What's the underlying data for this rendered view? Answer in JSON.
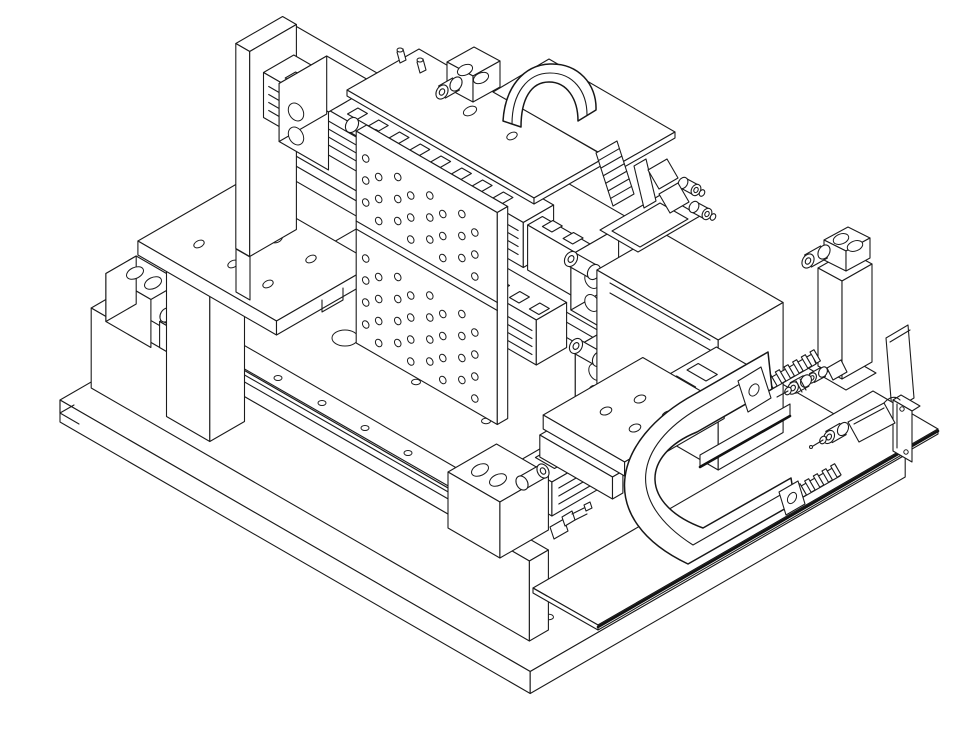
{
  "drawing": {
    "type": "isometric-cad-line-drawing",
    "subject": "Two-axis linear stage positioning assembly, isometric CAD view",
    "background_color": "#ffffff",
    "line_color": "#1b1b1b",
    "heavy_line_color": "#121212",
    "projection": "isometric",
    "has_text": false
  },
  "components": {
    "base_plate": {
      "label": "Machine base plate with mounting holes"
    },
    "left_riser_wall": {
      "label": "Left riser support wall"
    },
    "left_linear_rail": {
      "label": "Left linear guide rail"
    },
    "left_motor_block": {
      "label": "Left rail end motor block"
    },
    "left_support_column": {
      "label": "Left support column"
    },
    "left_tooling_plate": {
      "label": "Left tooling plate with holes"
    },
    "gantry_beam": {
      "label": "Gantry beam body"
    },
    "upper_linear_stage": {
      "label": "Upper linear stage rail"
    },
    "upper_stage_motor_left": {
      "label": "Upper stage motor block, left end"
    },
    "upper_stage_motor_right": {
      "label": "Upper stage motor block, right end"
    },
    "lower_linear_stage": {
      "label": "Lower linear stage rail"
    },
    "lower_stage_motor": {
      "label": "Lower stage motor block"
    },
    "perforated_mounting_plate": {
      "label": "Perforated vertical mounting plate"
    },
    "top_cover_plate": {
      "label": "Top carriage cover plate"
    },
    "top_motor_unit": {
      "label": "Top axis motor unit"
    },
    "cable_arch": {
      "label": "Cable duct arch"
    },
    "bellows_connectors": {
      "label": "Bellows section with plug connectors"
    },
    "right_housing": {
      "label": "Right stage housing block"
    },
    "bottom_linear_stage": {
      "label": "Bottom linear stage on base"
    },
    "carriage_table": {
      "label": "Moving carriage table"
    },
    "cable_tray": {
      "label": "Cable guide tray"
    },
    "carrier_teeth_upper": {
      "label": "Cable carrier link teeth, upper end"
    },
    "carrier_teeth_lower": {
      "label": "Cable carrier link teeth, lower end"
    },
    "cable_carrier_loop": {
      "label": "Cable carrier C-loop"
    },
    "carrier_tab_upper": {
      "label": "Carrier mounting tab, upper"
    },
    "carrier_tab_lower": {
      "label": "Carrier mounting tab, lower"
    },
    "breakout_plate": {
      "label": "Flat breakout sheet plate"
    },
    "d_sub_connector": {
      "label": "D-sub connector on bracket"
    },
    "right_support_column": {
      "label": "Right support column with motor"
    },
    "inline_connectors": {
      "label": "Inline cable connectors"
    },
    "limit_switch": {
      "label": "Limit switch assembly"
    }
  }
}
